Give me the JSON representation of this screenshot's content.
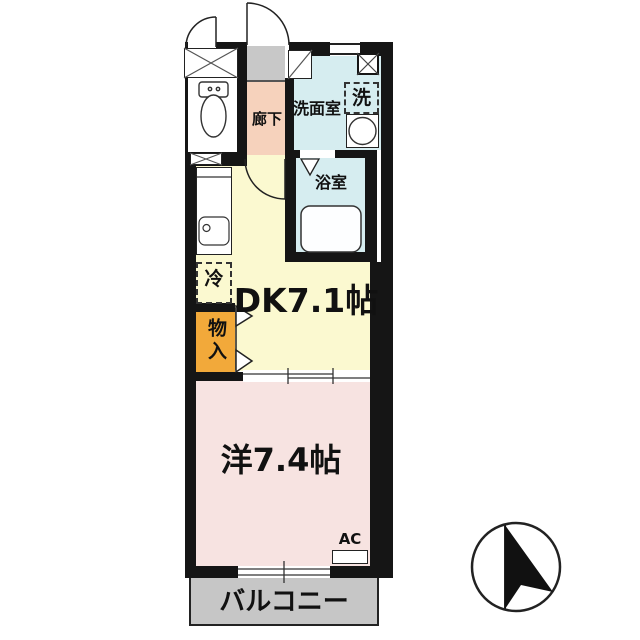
{
  "floorplan": {
    "labels": {
      "hallway": "廊下",
      "washroom": "洗面室",
      "washer": "洗",
      "bathroom": "浴室",
      "dining_kitchen": "DK7.1帖",
      "refrigerator": "冷",
      "closet": "物入",
      "western_room": "洋7.4帖",
      "air_conditioner": "AC",
      "balcony": "バルコニー"
    },
    "colors": {
      "wall": "#151515",
      "dk_floor": "#fbf9d0",
      "western_floor": "#f7e3e1",
      "hall_floor": "#f6d2bc",
      "genkan_floor": "#c8c8c8",
      "wet_area_floor": "#d6edf0",
      "closet_fill": "#f2a93a",
      "balcony_floor": "#c6c6c6"
    },
    "compass": {
      "type": "north-arrow",
      "direction": "up"
    }
  }
}
